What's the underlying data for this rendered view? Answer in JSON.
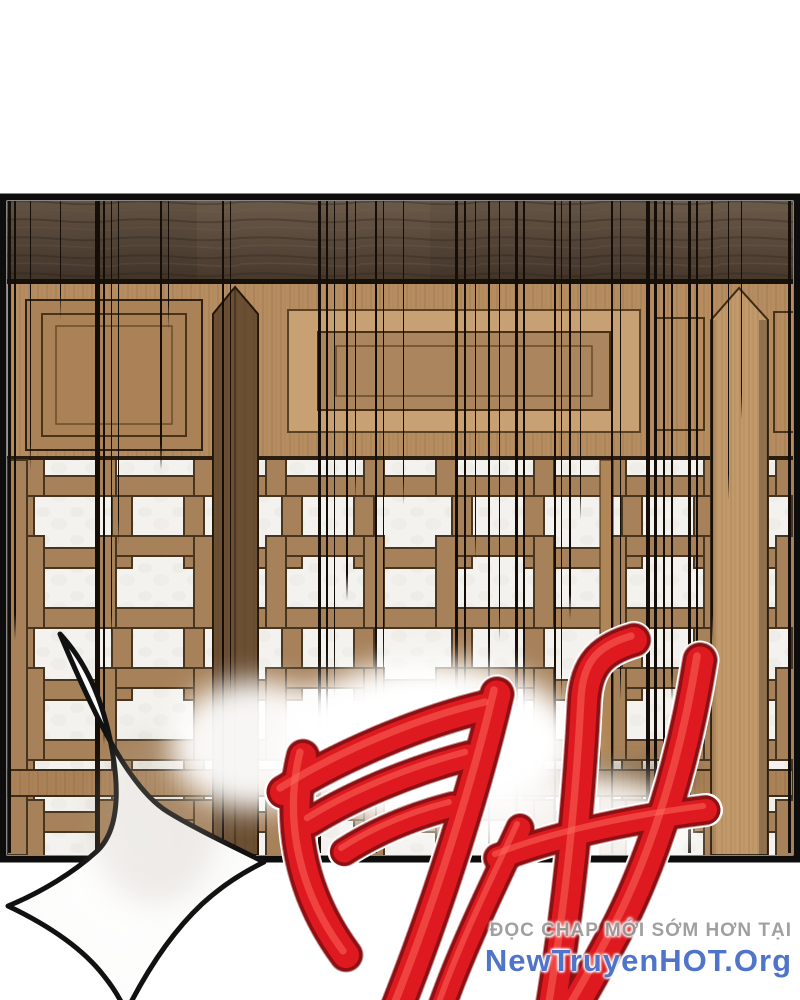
{
  "watermark": {
    "line1": "ĐỌC CHAP MỚI SỚM HƠN TẠI",
    "line2": "NewTruyenHOT.Org",
    "line1_color": "#9b9b9b",
    "line2_color": "#4f74c9"
  },
  "sfx": {
    "description": "large red brush-stroke impact sound effect"
  },
  "art_colors": {
    "paper": "#f3f2ee",
    "beam": "#57473a",
    "rail": "#b68d60",
    "lattice_bar": "#a6815a",
    "lattice_outline": "#473520",
    "stile": "#6b4f33",
    "post": "#c2996a",
    "panel_border": "#0d0d0d",
    "speed_line": "#140d08",
    "burst_fill": "#ffffff",
    "burst_outline": "#111111",
    "sfx_red": "#de1a20",
    "sfx_dark_red": "#8e1013",
    "sfx_stipple": "#7a0b0e",
    "sfx_casing": "#ffffff",
    "sfx_sheen": "#ff6b60"
  }
}
